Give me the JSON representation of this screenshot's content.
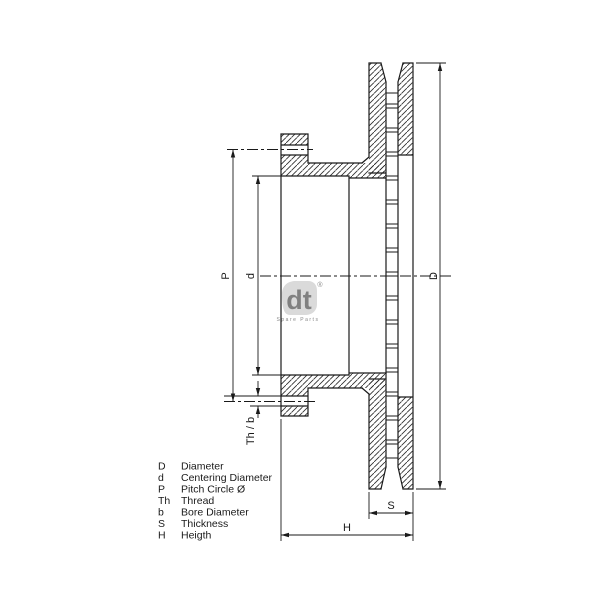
{
  "drawing": {
    "type": "brake-disc-cross-section",
    "dimension_labels": {
      "D": "D",
      "d": "d",
      "P": "P",
      "Th_b": "Th / b",
      "S": "S",
      "H": "H"
    }
  },
  "legend": {
    "rows": [
      {
        "symbol": "D",
        "label": "Diameter"
      },
      {
        "symbol": "d",
        "label": "Centering Diameter"
      },
      {
        "symbol": "P",
        "label": "Pitch Circle Ø"
      },
      {
        "symbol": "Th",
        "label": "Thread"
      },
      {
        "symbol": "b",
        "label": "Bore Diameter"
      },
      {
        "symbol": "S",
        "label": "Thickness"
      },
      {
        "symbol": "H",
        "label": "Heigth"
      }
    ]
  },
  "watermark": {
    "monogram": "dt",
    "registered": "®",
    "wordmark": "Spare Parts"
  },
  "colors": {
    "line": "#1a1a1a",
    "hatch": "#2a2a2a",
    "watermark_gray": "#bdbdbd"
  }
}
